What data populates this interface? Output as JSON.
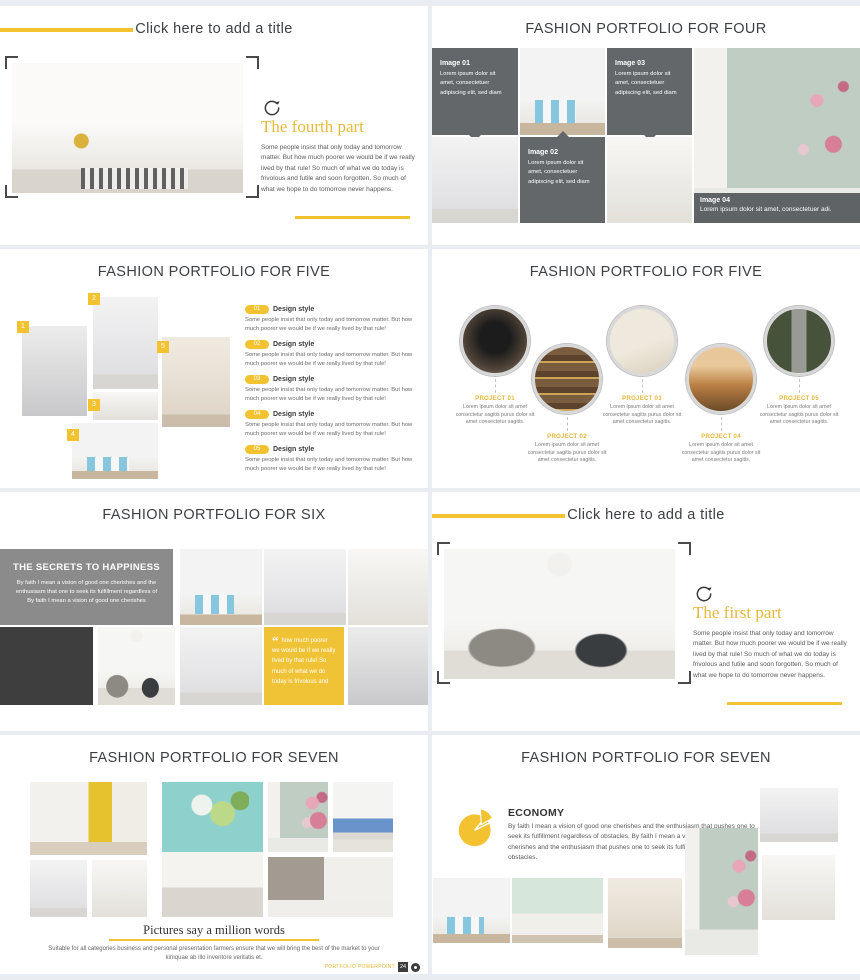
{
  "colors": {
    "accent": "#f2c230",
    "heading": "#e5b93c",
    "title_text": "#3d4043",
    "caption_gray": "#63676a"
  },
  "slides": {
    "sec4": {
      "title": "Click here to add a title",
      "heading": "The fourth part",
      "body": "Some people insist that only today and tomorrow matter. But how much poorer we would be if we really lived by that rule! So much of what we do today is frivolous and futile and soon forgotten. So much of what we hope to do tomorrow never happens."
    },
    "four": {
      "title": "FASHION PORTFOLIO FOR FOUR",
      "items": [
        {
          "label": "Image 01",
          "text": "Lorem ipsum dolor sit amet, consectetuer adipiscing elit, sed diam"
        },
        {
          "label": "Image 02",
          "text": "Lorem ipsum dolor sit amet, consectetuer adipiscing elit, sed diam"
        },
        {
          "label": "Image 03",
          "text": "Lorem ipsum dolor sit amet, consectetuer adipiscing elit, sed diam"
        },
        {
          "label": "Image 04",
          "text": "Lorem ipsum dolor sit amet, consectetuer adi."
        }
      ]
    },
    "five_a": {
      "title": "FASHION PORTFOLIO FOR FIVE",
      "tags": [
        "1",
        "2",
        "3",
        "4",
        "5"
      ],
      "items": [
        {
          "num": "01",
          "label": "Design style",
          "text": "Some people insist that only today and tomorrow matter. But how much poorer we would be if we really lived by that rule!"
        },
        {
          "num": "02",
          "label": "Design style",
          "text": "Some people insist that only today and tomorrow matter. But how much poorer we would be if we really lived by that rule!"
        },
        {
          "num": "03",
          "label": "Design style",
          "text": "Some people insist that only today and tomorrow matter. But how much poorer we would be if we really lived by that rule!"
        },
        {
          "num": "04",
          "label": "Design style",
          "text": "Some people insist that only today and tomorrow matter. But how much poorer we would be if we really lived by that rule!"
        },
        {
          "num": "05",
          "label": "Design style",
          "text": "Some people insist that only today and tomorrow matter. But how much poorer we would be if we really lived by that rule!"
        }
      ]
    },
    "five_b": {
      "title": "FASHION PORTFOLIO FOR FIVE",
      "projects": [
        {
          "label": "PROJECT 01",
          "text": "Lorem ipsum dolor sit amet consectetur sagitis purus dolor sit amet consectetur sagitis."
        },
        {
          "label": "PROJECT 02",
          "text": "Lorem ipsum dolor sit amet consectetur sagitis purus dolor sit amet consectetur sagitis."
        },
        {
          "label": "PROJECT 03",
          "text": "Lorem ipsum dolor sit amet consectetur sagitis purus dolor sit amet consectetur sagitis."
        },
        {
          "label": "PROJECT 04",
          "text": "Lorem ipsum dolor sit amet consectetur sagitis purus dolor sit amet consectetur sagitis."
        },
        {
          "label": "PROJECT 05",
          "text": "Lorem ipsum dolor sit amet consectetur sagitis purus dolor sit amet consectetur sagitis."
        }
      ]
    },
    "six": {
      "title": "FASHION PORTFOLIO FOR SIX",
      "panel_heading": "THE SECRETS TO HAPPINESS",
      "panel_text": "By faith I mean a vision of good one cherishes and the enthusiasm that one to seek its fulfillment regardless of By faith I mean a vision of good one cherishes",
      "quote_mark": "“",
      "quote": "how much poorer we would be if we really lived by that rule! So much of what we do today is frivolous and"
    },
    "sec1": {
      "title": "Click here to add a title",
      "heading": "The first part",
      "body": "Some people insist that only today and tomorrow matter. But how much poorer we would be if we really lived by that rule! So much of what we do today is frivolous and futile and soon forgotten. So much of what we hope to do tomorrow never happens."
    },
    "seven_a": {
      "title": "FASHION PORTFOLIO FOR SEVEN",
      "caption_heading": "Pictures say a million words",
      "caption_text": "Suitable for all categories business and personal presentation farmers ensure that we will bring the best of the market to your kimquae ab illo inventore veritatis et.",
      "footer_label": "PORTFOLIO POWERPOINT",
      "page_number": "24"
    },
    "seven_b": {
      "title": "FASHION PORTFOLIO FOR SEVEN",
      "heading": "ECONOMY",
      "body": "By faith I mean a vision of good one cherishes and the enthusiasm that pushes one to seek its fulfillment regardless of obstacles. By faith I mean a vision of good one cherishes and the enthusiasm that pushes one to seek its fulfillment regardless of obstacles."
    }
  }
}
